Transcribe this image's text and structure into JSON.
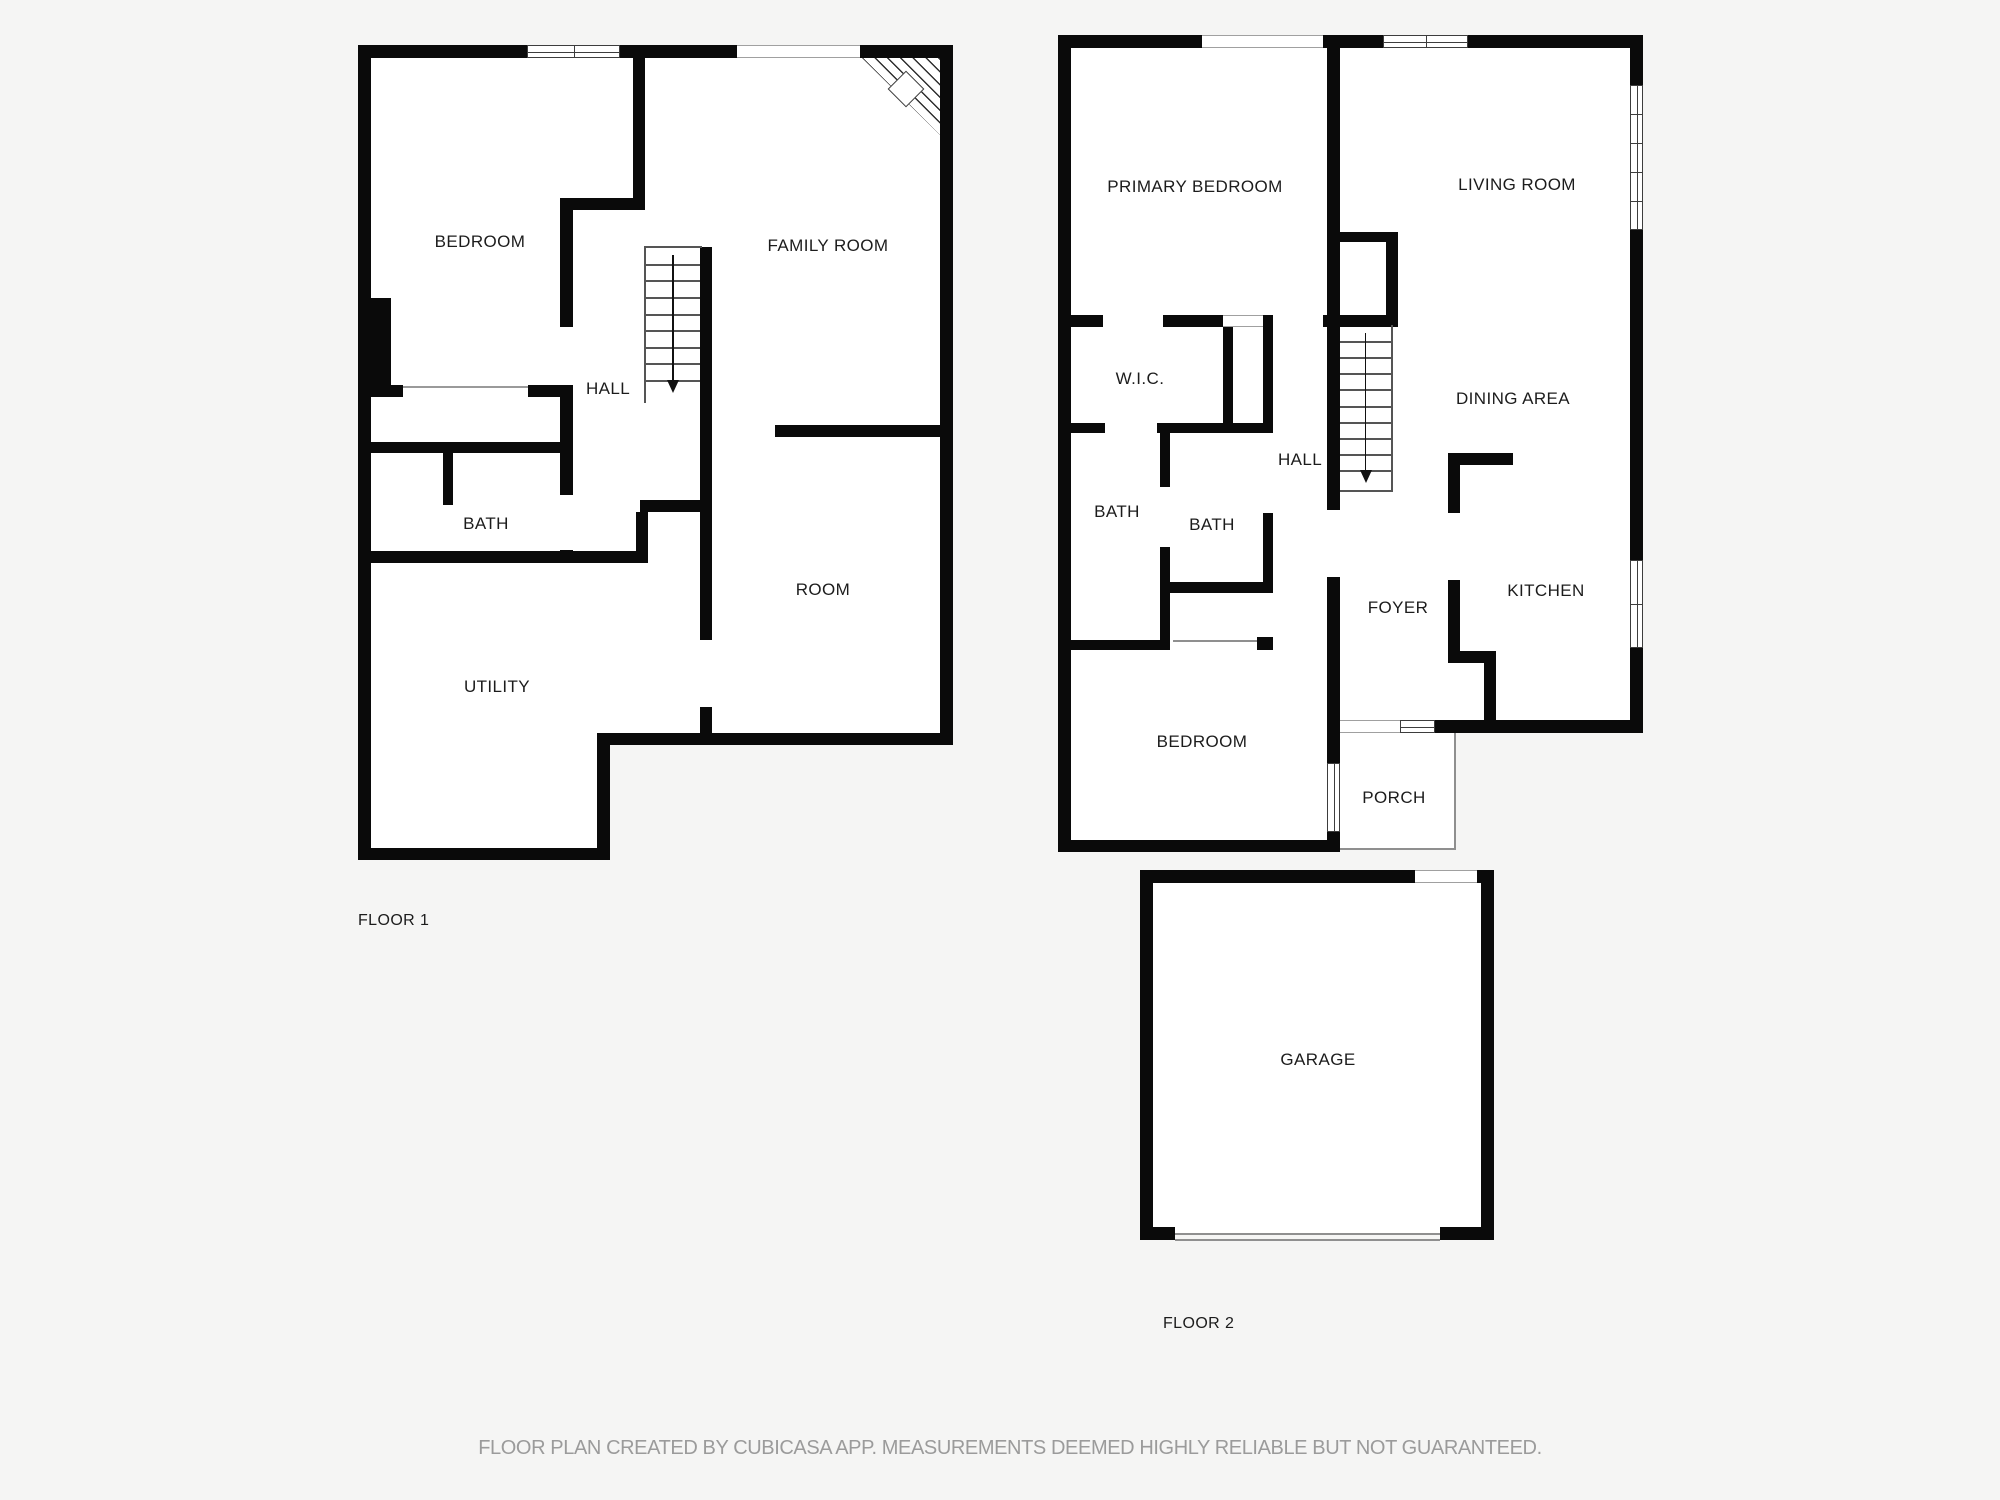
{
  "meta": {
    "floor1_label": "FLOOR 1",
    "floor2_label": "FLOOR 2",
    "disclaimer": "FLOOR PLAN CREATED BY CUBICASA APP. MEASUREMENTS DEEMED HIGHLY RELIABLE BUT NOT GUARANTEED."
  },
  "colors": {
    "background": "#f5f5f4",
    "floor": "#ffffff",
    "wall": "#0a0a0a",
    "frame": "#3d3d3d",
    "light_line": "#a0a0a0",
    "thin": "#8f8f8f",
    "tread": "#555555",
    "label": "#1c1c1c",
    "muted": "#9b9b9b"
  },
  "floor_tags": [
    {
      "text": "FLOOR 1",
      "x": 358,
      "y": 912
    },
    {
      "text": "FLOOR 2",
      "x": 1163,
      "y": 1315
    }
  ],
  "rooms": [
    {
      "floor": 1,
      "name": "BEDROOM",
      "x": 480,
      "y": 242
    },
    {
      "floor": 1,
      "name": "FAMILY ROOM",
      "x": 828,
      "y": 246
    },
    {
      "floor": 1,
      "name": "HALL",
      "x": 608,
      "y": 389
    },
    {
      "floor": 1,
      "name": "BATH",
      "x": 486,
      "y": 524
    },
    {
      "floor": 1,
      "name": "ROOM",
      "x": 823,
      "y": 590
    },
    {
      "floor": 1,
      "name": "UTILITY",
      "x": 497,
      "y": 687
    },
    {
      "floor": 2,
      "name": "PRIMARY BEDROOM",
      "x": 1195,
      "y": 187
    },
    {
      "floor": 2,
      "name": "LIVING ROOM",
      "x": 1517,
      "y": 185
    },
    {
      "floor": 2,
      "name": "W.I.C.",
      "x": 1140,
      "y": 379
    },
    {
      "floor": 2,
      "name": "HALL",
      "x": 1300,
      "y": 460
    },
    {
      "floor": 2,
      "name": "DINING AREA",
      "x": 1513,
      "y": 399
    },
    {
      "floor": 2,
      "name": "BATH",
      "x": 1117,
      "y": 512
    },
    {
      "floor": 2,
      "name": "BATH",
      "x": 1212,
      "y": 525
    },
    {
      "floor": 2,
      "name": "FOYER",
      "x": 1398,
      "y": 608
    },
    {
      "floor": 2,
      "name": "KITCHEN",
      "x": 1546,
      "y": 591
    },
    {
      "floor": 2,
      "name": "BEDROOM",
      "x": 1202,
      "y": 742
    },
    {
      "floor": 2,
      "name": "PORCH",
      "x": 1394,
      "y": 798
    },
    {
      "floor": 2,
      "name": "GARAGE",
      "x": 1318,
      "y": 1060
    }
  ],
  "geometry": {
    "fills": [
      [
        365,
        50,
        578,
        690
      ],
      [
        365,
        50,
        240,
        805
      ],
      [
        1065,
        42,
        570,
        685
      ],
      [
        1065,
        42,
        270,
        803
      ],
      [
        1334,
        733,
        121,
        116
      ],
      [
        1147,
        877,
        340,
        356
      ]
    ],
    "walls": [
      [
        358,
        45,
        169,
        13
      ],
      [
        620,
        45,
        117,
        13
      ],
      [
        860,
        45,
        93,
        13
      ],
      [
        358,
        45,
        13,
        815
      ],
      [
        940,
        45,
        13,
        700
      ],
      [
        602,
        733,
        351,
        12
      ],
      [
        597,
        733,
        13,
        127
      ],
      [
        358,
        848,
        252,
        12
      ],
      [
        371,
        298,
        20,
        92
      ],
      [
        358,
        385,
        45,
        12
      ],
      [
        528,
        385,
        45,
        12
      ],
      [
        560,
        204,
        13,
        123
      ],
      [
        560,
        198,
        85,
        12
      ],
      [
        633,
        45,
        12,
        165
      ],
      [
        358,
        442,
        214,
        11
      ],
      [
        560,
        397,
        13,
        98
      ],
      [
        560,
        550,
        13,
        13
      ],
      [
        443,
        453,
        10,
        52
      ],
      [
        358,
        551,
        290,
        12
      ],
      [
        636,
        512,
        12,
        39
      ],
      [
        700,
        247,
        12,
        393
      ],
      [
        640,
        500,
        72,
        12
      ],
      [
        775,
        425,
        178,
        12
      ],
      [
        700,
        707,
        12,
        38
      ],
      [
        1062,
        35,
        140,
        13
      ],
      [
        1323,
        35,
        60,
        13
      ],
      [
        1468,
        35,
        175,
        13
      ],
      [
        1058,
        35,
        13,
        817
      ],
      [
        1630,
        35,
        13,
        50
      ],
      [
        1630,
        230,
        13,
        330
      ],
      [
        1630,
        648,
        13,
        85
      ],
      [
        1435,
        720,
        208,
        13
      ],
      [
        1058,
        840,
        282,
        12
      ],
      [
        1327,
        48,
        13,
        462
      ],
      [
        1327,
        232,
        71,
        10
      ],
      [
        1386,
        242,
        12,
        73
      ],
      [
        1327,
        577,
        13,
        186
      ],
      [
        1327,
        832,
        13,
        20
      ],
      [
        1058,
        315,
        45,
        12
      ],
      [
        1163,
        315,
        60,
        12
      ],
      [
        1263,
        315,
        10,
        12
      ],
      [
        1323,
        315,
        75,
        12
      ],
      [
        1223,
        327,
        10,
        96
      ],
      [
        1263,
        327,
        10,
        106
      ],
      [
        1058,
        423,
        47,
        10
      ],
      [
        1157,
        423,
        116,
        10
      ],
      [
        1160,
        433,
        10,
        54
      ],
      [
        1160,
        547,
        10,
        103
      ],
      [
        1160,
        582,
        113,
        11
      ],
      [
        1263,
        513,
        10,
        80
      ],
      [
        1058,
        640,
        112,
        10
      ],
      [
        1257,
        637,
        16,
        13
      ],
      [
        1448,
        453,
        65,
        12
      ],
      [
        1448,
        453,
        12,
        60
      ],
      [
        1448,
        580,
        12,
        83
      ],
      [
        1448,
        651,
        48,
        12
      ],
      [
        1484,
        663,
        12,
        70
      ],
      [
        1140,
        870,
        275,
        13
      ],
      [
        1477,
        870,
        17,
        13
      ],
      [
        1481,
        870,
        13,
        370
      ],
      [
        1140,
        870,
        13,
        370
      ],
      [
        1148,
        1227,
        27,
        13
      ],
      [
        1440,
        1227,
        54,
        13
      ]
    ],
    "windows": [
      {
        "x": 527,
        "y": 45,
        "w": 93,
        "h": 13,
        "o": "h",
        "style": "frame",
        "panes": 2
      },
      {
        "x": 737,
        "y": 45,
        "w": 123,
        "h": 13,
        "o": "h",
        "style": "light"
      },
      {
        "x": 1202,
        "y": 35,
        "w": 121,
        "h": 13,
        "o": "h",
        "style": "light"
      },
      {
        "x": 1383,
        "y": 35,
        "w": 85,
        "h": 13,
        "o": "h",
        "style": "frame",
        "panes": 2
      },
      {
        "x": 1630,
        "y": 85,
        "w": 13,
        "h": 145,
        "o": "v",
        "style": "frame",
        "panes": 5
      },
      {
        "x": 1630,
        "y": 560,
        "w": 13,
        "h": 88,
        "o": "v",
        "style": "frame",
        "panes": 2
      },
      {
        "x": 1400,
        "y": 720,
        "w": 35,
        "h": 13,
        "o": "h",
        "style": "frame",
        "panes": 1
      },
      {
        "x": 1340,
        "y": 720,
        "w": 60,
        "h": 13,
        "o": "h",
        "style": "light"
      },
      {
        "x": 1327,
        "y": 763,
        "w": 13,
        "h": 69,
        "o": "v",
        "style": "frame",
        "panes": 1
      },
      {
        "x": 1223,
        "y": 315,
        "w": 40,
        "h": 12,
        "o": "h",
        "style": "light"
      },
      {
        "x": 1415,
        "y": 870,
        "w": 62,
        "h": 13,
        "o": "h",
        "style": "light"
      }
    ],
    "lines": [
      [
        403,
        386,
        125,
        2,
        "#9a9a9a"
      ],
      [
        644,
        246,
        58,
        2,
        "#555555"
      ],
      [
        644,
        247,
        2,
        156,
        "#555555"
      ],
      [
        1391,
        325,
        2,
        167,
        "#555555"
      ],
      [
        1340,
        490,
        53,
        2,
        "#555555"
      ],
      [
        1173,
        640,
        84,
        2,
        "#8f8f8f"
      ],
      [
        1454,
        733,
        2,
        117,
        "#8f8f8f"
      ],
      [
        1340,
        848,
        116,
        2,
        "#8f8f8f"
      ],
      [
        1175,
        1233,
        265,
        2,
        "#8f8f8f"
      ],
      [
        1175,
        1239,
        265,
        2,
        "#8f8f8f"
      ]
    ],
    "stairs": [
      {
        "x": 646,
        "y": 247,
        "w": 54,
        "h": 153,
        "treads": 8
      },
      {
        "x": 1340,
        "y": 325,
        "w": 51,
        "h": 165,
        "treads": 9
      }
    ],
    "fireplace": {
      "x": 862,
      "y": 58,
      "w": 78,
      "h": 77,
      "diamond": {
        "cx": 905,
        "cy": 88,
        "size": 24
      }
    }
  }
}
